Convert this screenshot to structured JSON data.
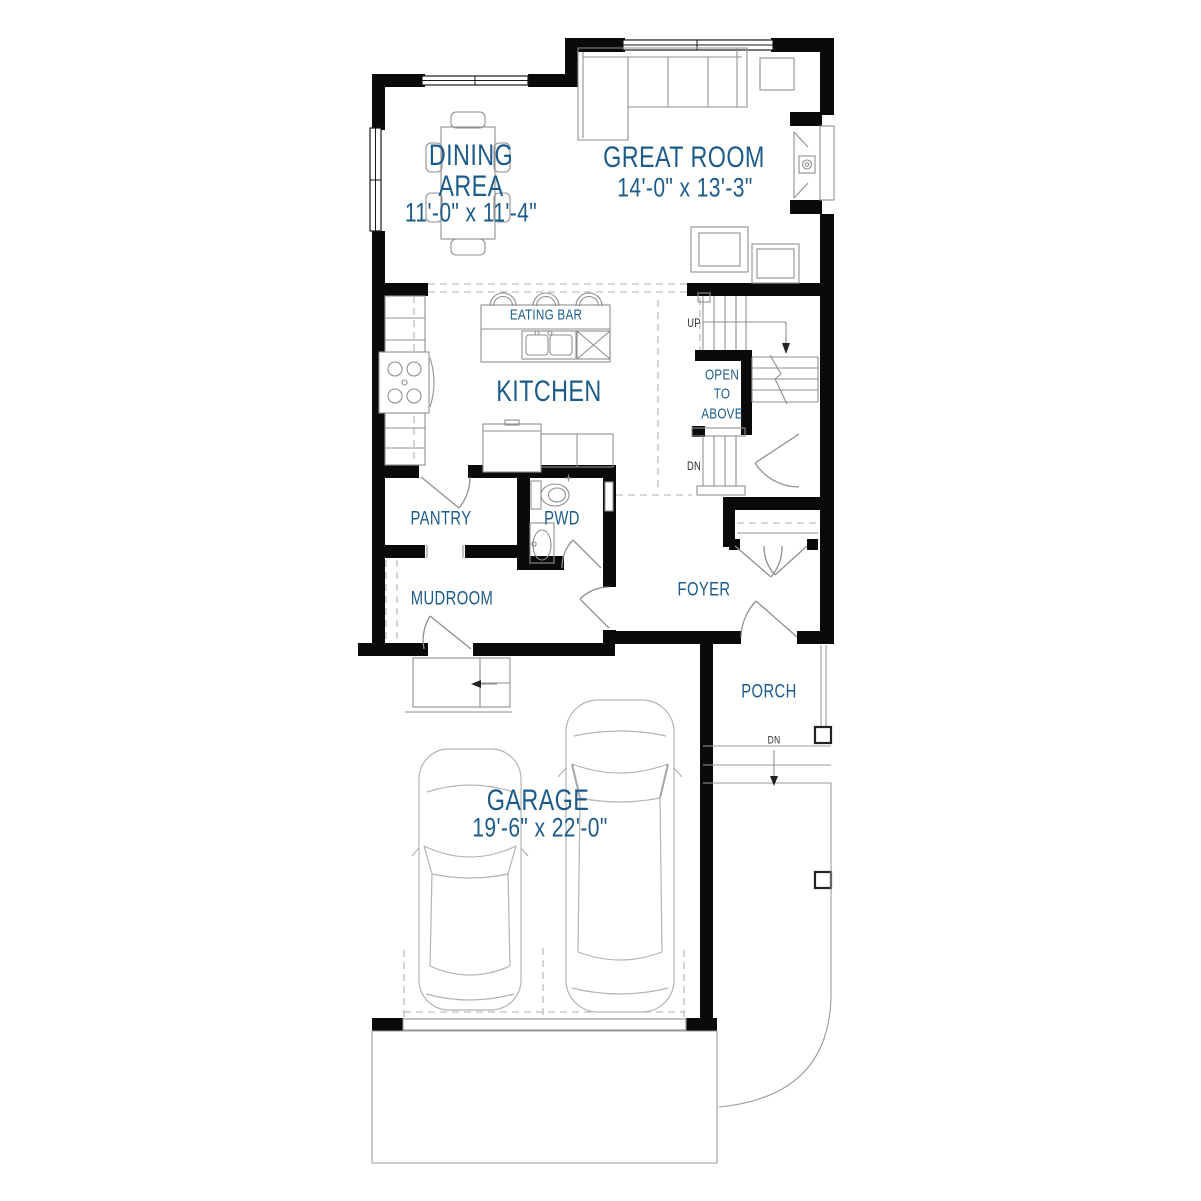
{
  "colors": {
    "label_blue": "#1d5c8a",
    "annotation_dark": "#2b2b2b",
    "wall_black": "#0a0a0a",
    "line_gray": "#8f8f8f",
    "light_gray": "#b3b3b3"
  },
  "rooms": {
    "dining": {
      "line1": "DINING",
      "line2": "AREA",
      "dims": "11'-0\" x 11'-4\""
    },
    "great_room": {
      "name": "GREAT ROOM",
      "dims": "14'-0\" x 13'-3\""
    },
    "kitchen": {
      "name": "KITCHEN"
    },
    "eating_bar": {
      "name": "EATING BAR"
    },
    "open_to_above": {
      "line1": "OPEN",
      "line2": "TO",
      "line3": "ABOVE"
    },
    "pantry": {
      "name": "PANTRY"
    },
    "powder_room": {
      "name": "PWD"
    },
    "mudroom": {
      "name": "MUDROOM"
    },
    "foyer": {
      "name": "FOYER"
    },
    "porch": {
      "name": "PORCH"
    },
    "garage": {
      "name": "GARAGE",
      "dims": "19'-6\" x 22'-0\""
    }
  },
  "annotations": {
    "stairs_up": "UP",
    "stairs_down": "DN",
    "porch_down": "DN"
  }
}
